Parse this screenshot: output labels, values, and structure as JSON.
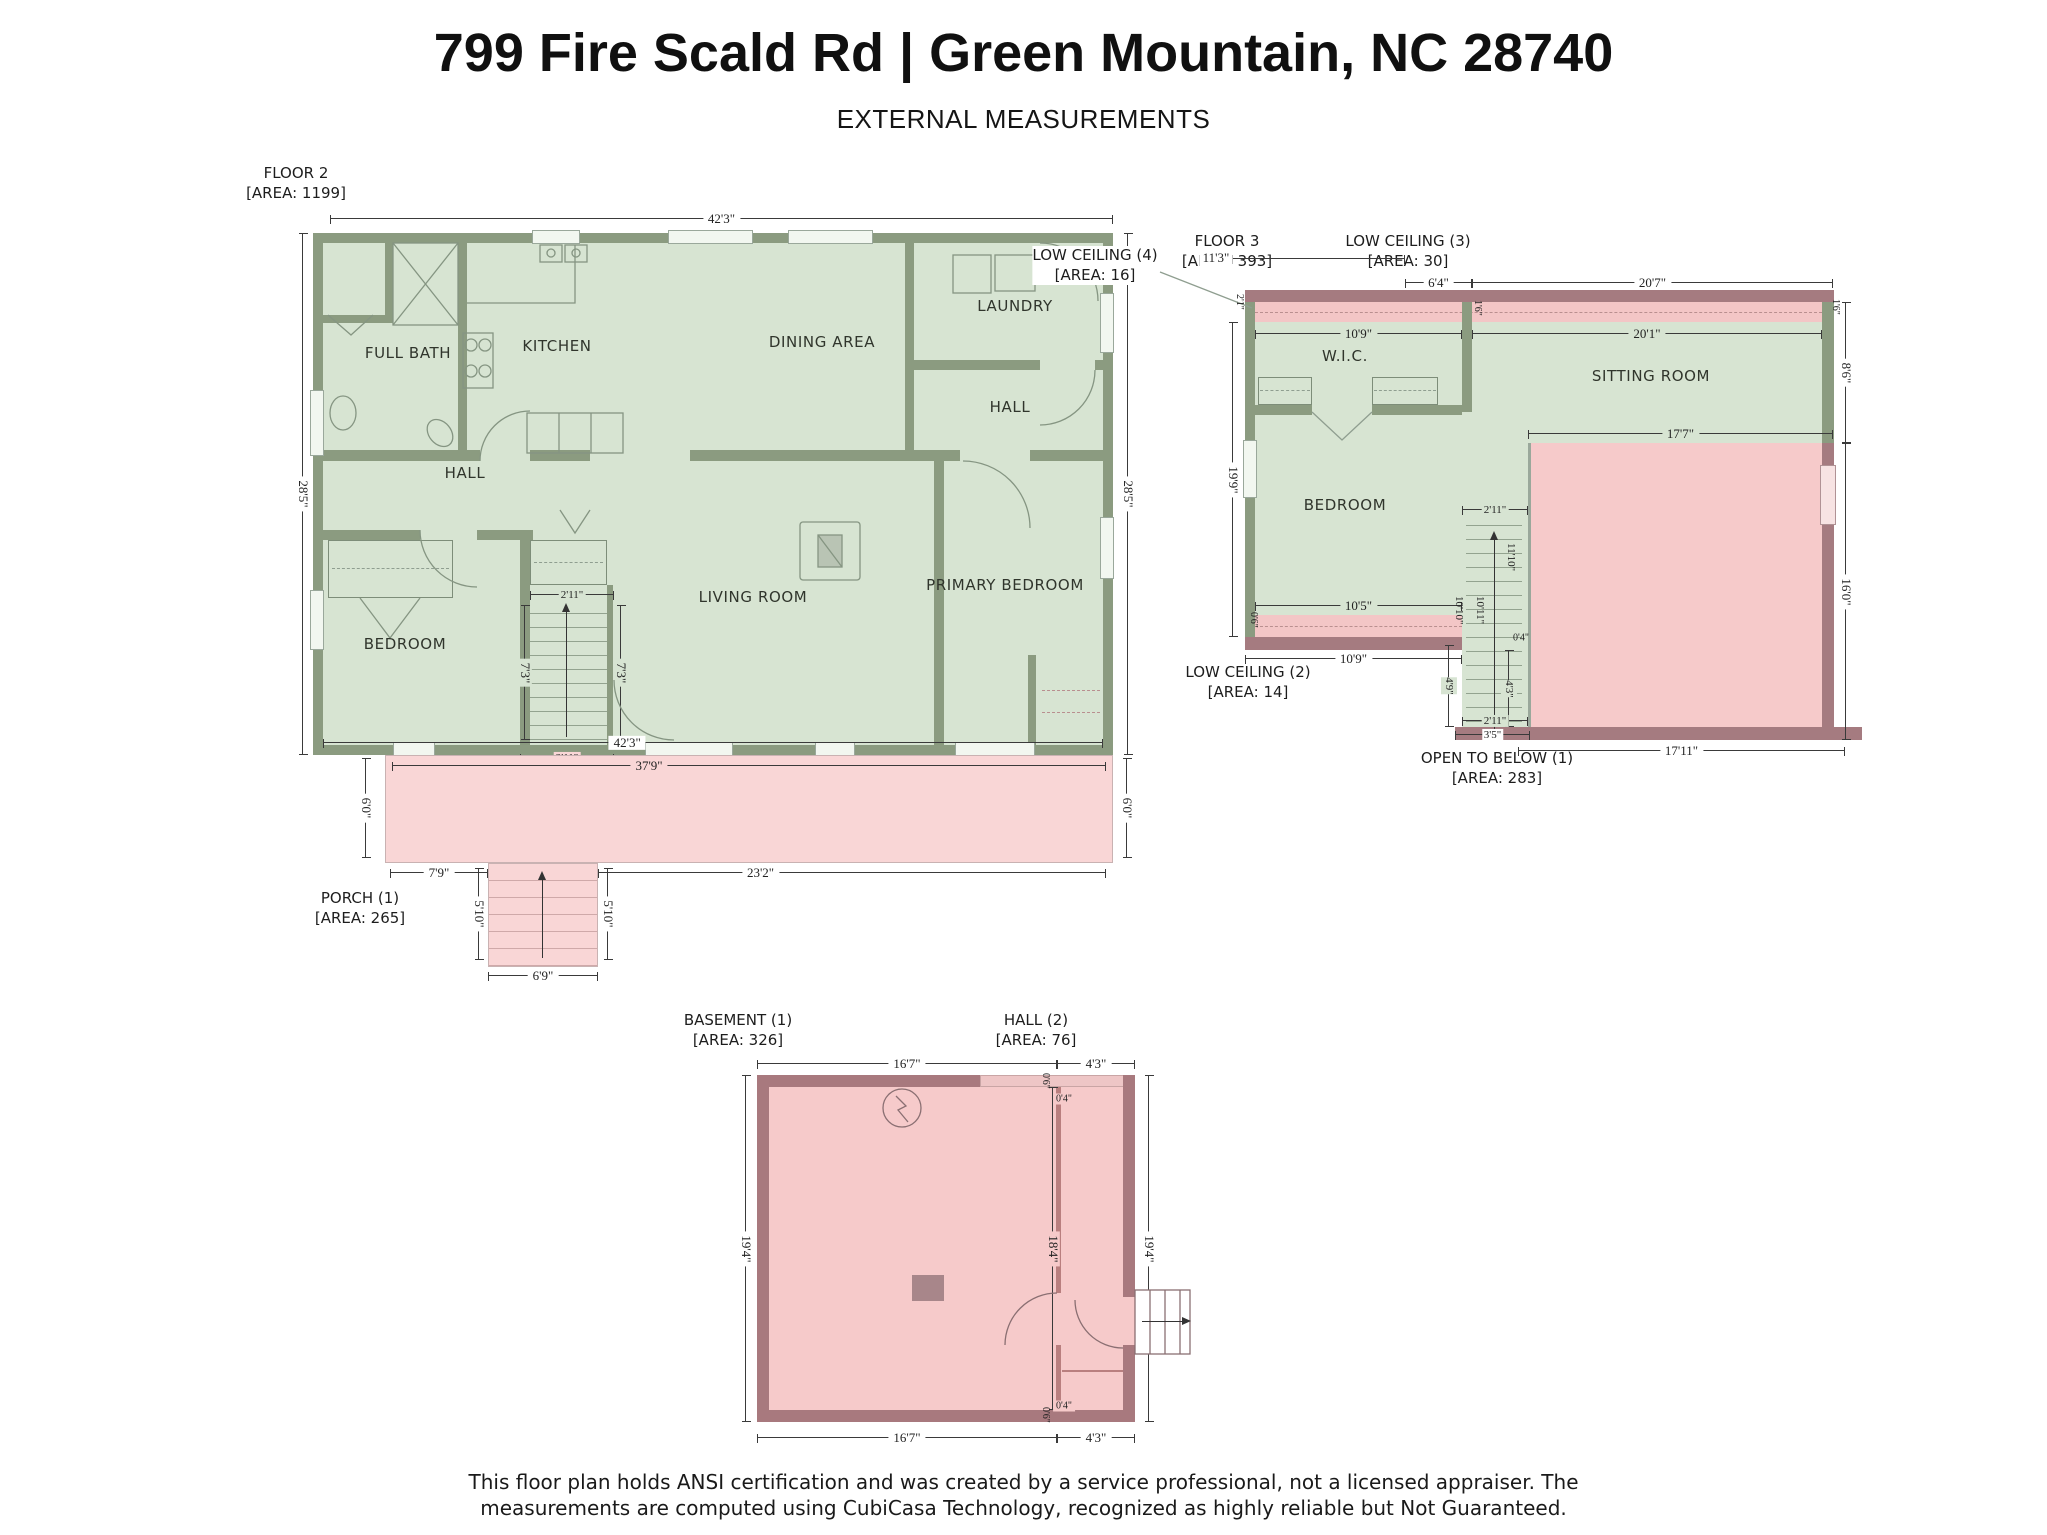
{
  "page": {
    "title": "799 Fire Scald Rd | Green Mountain, NC 28740",
    "subtitle": "EXTERNAL MEASUREMENTS",
    "footer_line1": "This floor plan holds ANSI certification and was created by a service professional, not a licensed appraiser. The",
    "footer_line2": "measurements are computed using CubiCasa Technology, recognized as highly reliable but Not Guaranteed."
  },
  "colors": {
    "room_green": "#d7e4d2",
    "wall_green": "#8b9b80",
    "porch_pink": "#f9d6d6",
    "open_pink": "#f6caca",
    "wall_mauve": "#a57b80",
    "dim_text": "#2d2d2d"
  },
  "floor2": {
    "label": "FLOOR 2",
    "area": "[AREA: 1199]",
    "rooms": {
      "full_bath": "FULL BATH",
      "kitchen": "KITCHEN",
      "dining_area": "DINING AREA",
      "laundry": "LAUNDRY",
      "hall_upper": "HALL",
      "hall_lower": "HALL",
      "bedroom": "BEDROOM",
      "living_room": "LIVING ROOM",
      "primary_bedroom": "PRIMARY BEDROOM"
    },
    "dims": {
      "top": "42'3\"",
      "bottom": "42'3\"",
      "left": "28'5\"",
      "right": "28'5\"",
      "stair_top": "2'11\"",
      "stair_bottom": "2'11\"",
      "stair_left": "7'3\"",
      "stair_right": "7'3\""
    }
  },
  "porch": {
    "label": "PORCH (1)",
    "area": "[AREA: 265]",
    "dims": {
      "width": "37'9\"",
      "left": "6'0\"",
      "right": "6'0\"",
      "seg_left": "7'9\"",
      "seg_right": "23'2\"",
      "steps_left": "5'10\"",
      "steps_right": "5'10\"",
      "steps_width": "6'9\""
    }
  },
  "floor3": {
    "label": "FLOOR 3",
    "area": "[AREA: 393]",
    "low_ceiling_3": "LOW CEILING (3)",
    "low_ceiling_3_area": "[AREA: 30]",
    "low_ceiling_4": "LOW CEILING (4)",
    "low_ceiling_4_area": "[AREA: 16]",
    "low_ceiling_2": "LOW CEILING (2)",
    "low_ceiling_2_area": "[AREA: 14]",
    "open_below": "OPEN TO BELOW (1)",
    "open_below_area": "[AREA: 283]",
    "rooms": {
      "wic": "W.I.C.",
      "sitting_room": "SITTING ROOM",
      "bedroom": "BEDROOM"
    },
    "dims": {
      "top_left": "11'3\"",
      "top_mid": "6'4\"",
      "top_right": "20'7\"",
      "sitting_width": "20'1\"",
      "strip_height": "1'6\"",
      "corner_right": "1'6\"",
      "right_upper": "8'6\"",
      "right_lower": "16'0\"",
      "left_height": "19'9\"",
      "left_top_tiny": "2'1\"",
      "wic_width": "10'9\"",
      "bedroom_width": "10'5\"",
      "bedroom_width_outer": "10'9\"",
      "left_bottom_tiny": "0'6\"",
      "open_top": "17'7\"",
      "open_bottom": "17'11\"",
      "stair_width": "2'11\"",
      "stair_right": "11'10\"",
      "stair_mid": "10'11\"",
      "stair_left": "10'10\"",
      "stair_small": "0'4\"",
      "open_left_upper": "4'9\"",
      "open_left_lower": "4'3\"",
      "open_width_small": "2'11\"",
      "open_width_small2": "3'5\""
    }
  },
  "basement": {
    "label": "BASEMENT (1)",
    "area": "[AREA: 326]",
    "hall_label": "HALL (2)",
    "hall_area": "[AREA: 76]",
    "dims": {
      "top_left": "16'7\"",
      "top_right": "4'3\"",
      "bottom_left": "16'7\"",
      "bottom_right": "4'3\"",
      "left": "19'4\"",
      "right": "19'4\"",
      "mid": "18'4\"",
      "tiny_top": "0'4\"",
      "tiny_bottom": "0'4\"",
      "tiny_top2": "0'6\"",
      "tiny_bottom2": "0'6\""
    }
  }
}
